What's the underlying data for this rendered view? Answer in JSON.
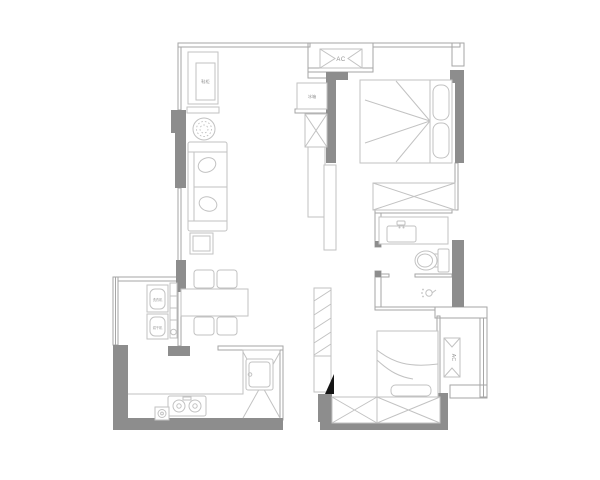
{
  "page": {
    "kind": "apartment-floor-plan-drawing",
    "background": "#ffffff"
  },
  "colors": {
    "paper": "#ffffff",
    "wall": "#8d8d8d",
    "line": "#a6a6a6",
    "furn": "#c2c2c2",
    "text": "#949494",
    "ink": "#141414"
  },
  "labels": {
    "ac_top": "AC",
    "ac_side": "AC",
    "shoe_cabinet": "鞋柜",
    "fridge": "冰箱",
    "washer": "洗衣机",
    "dryer": "烘干机"
  }
}
